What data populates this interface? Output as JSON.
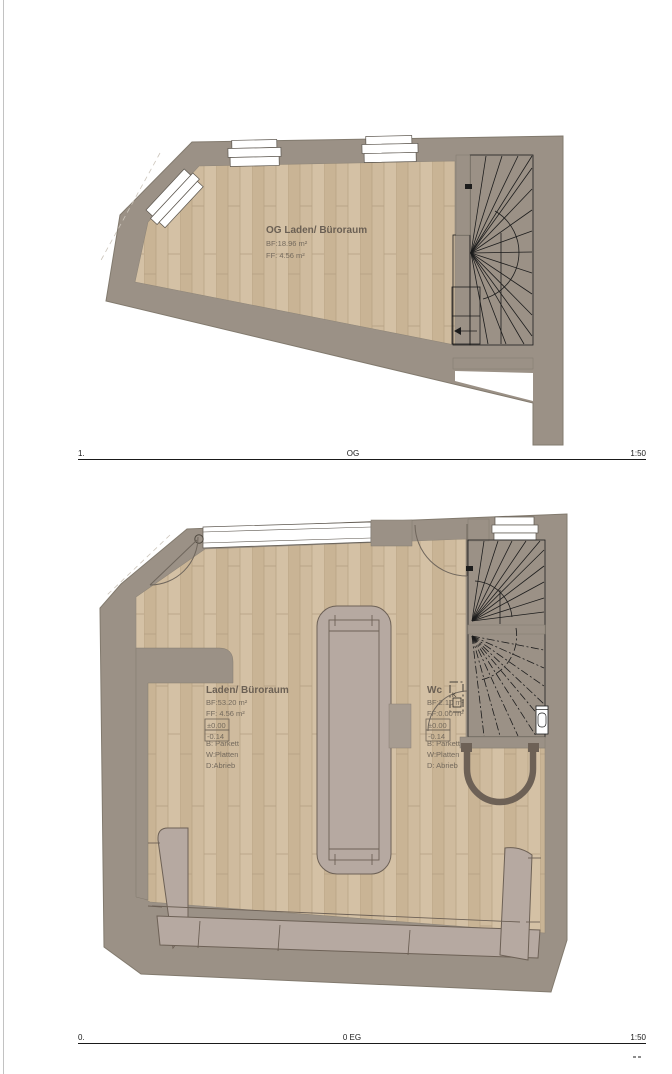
{
  "document": {
    "kind": "architectural floor plans",
    "page_border_color": "#c2c2c2"
  },
  "colors": {
    "wall": "#9b9186",
    "wall_stroke": "#827a6e",
    "floor": "#cfbb9d",
    "floor_stripe": "#b9a486",
    "counter": "#b6a9a1",
    "counter_stroke": "#6d6156",
    "stair_line": "#1c1c1c",
    "label_text": "#6b6054"
  },
  "plans": {
    "og": {
      "title": "OG Laden/ Büroraum",
      "bf": "BF:18.96 m²",
      "ff": "FF:  4.56 m²",
      "scale": {
        "left": "1.",
        "center": "OG",
        "right": "1:50"
      }
    },
    "eg": {
      "room": {
        "title": "Laden/ Büroraum",
        "bf": "BF:53.20 m²",
        "ff": "FF:  4.56 m²",
        "level_upper": "±0.00",
        "level_lower": "-0.14",
        "floor_finish": "B: Parkett",
        "wall_finish": "W:Platten",
        "ceiling_finish": "D:Abrieb"
      },
      "wc": {
        "title": "Wc",
        "bf": "BF:2.10 m²",
        "ff": "FF:0.00 m²",
        "level_upper": "±0.00",
        "level_lower": "-0.14",
        "floor_finish": "B: Parkett",
        "wall_finish": "W:Platten",
        "ceiling_finish": "D: Abrieb"
      },
      "stair_note": "K",
      "scale": {
        "left": "0.",
        "center": "0 EG",
        "right": "1:50"
      }
    }
  }
}
